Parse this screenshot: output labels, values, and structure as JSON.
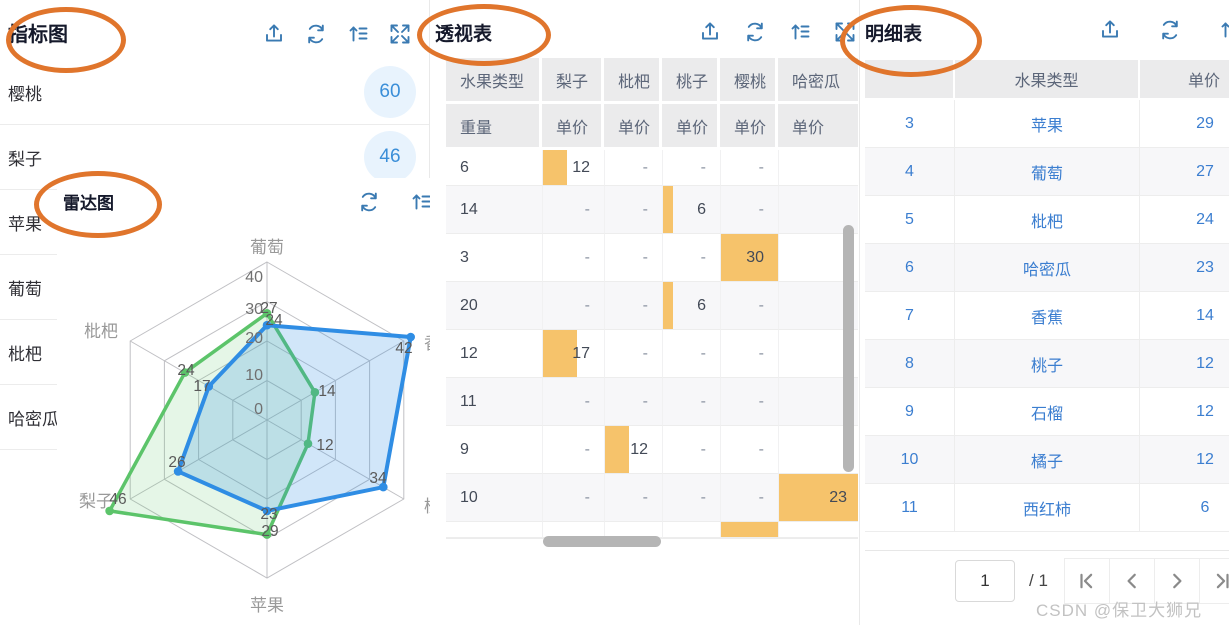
{
  "colors": {
    "annotation": "#e0752c",
    "toolbar_icon": "#3a7ab2",
    "orange_bar": "#f6c36b",
    "series_blue": "#2f8de4",
    "series_green": "#5cc46a",
    "badge_bg": "#e8f3fd",
    "badge_text": "#3a8ed8"
  },
  "indicator": {
    "title": "指标图",
    "toolbar": [
      "upload",
      "refresh",
      "sort",
      "expand"
    ],
    "items": [
      {
        "label": "樱桃",
        "value": "60"
      },
      {
        "label": "梨子",
        "value": "46"
      },
      {
        "label": "苹果",
        "value": ""
      },
      {
        "label": "葡萄",
        "value": ""
      },
      {
        "label": "枇杷",
        "value": ""
      },
      {
        "label": "哈密瓜",
        "value": ""
      }
    ]
  },
  "radar": {
    "title": "雷达图",
    "toolbar": [
      "refresh",
      "sort"
    ]
  },
  "pivot": {
    "title": "透视表",
    "toolbar": [
      "upload",
      "refresh",
      "sort",
      "expand"
    ],
    "columns": [
      "水果类型",
      "梨子",
      "枇杷",
      "桃子",
      "樱桃",
      "哈密瓜"
    ],
    "measures": [
      "重量",
      "单价",
      "单价",
      "单价",
      "单价",
      "单价"
    ],
    "rows": [
      {
        "weight": "6",
        "cells": [
          {
            "v": "12",
            "bar": 40
          },
          {
            "v": "-",
            "bar": 0
          },
          {
            "v": "-",
            "bar": 0
          },
          {
            "v": "-",
            "bar": 0
          },
          {
            "v": "",
            "bar": 0
          }
        ]
      },
      {
        "weight": "14",
        "cells": [
          {
            "v": "-",
            "bar": 0
          },
          {
            "v": "-",
            "bar": 0
          },
          {
            "v": "6",
            "bar": 18
          },
          {
            "v": "-",
            "bar": 0
          },
          {
            "v": "",
            "bar": 0
          }
        ]
      },
      {
        "weight": "3",
        "cells": [
          {
            "v": "-",
            "bar": 0
          },
          {
            "v": "-",
            "bar": 0
          },
          {
            "v": "-",
            "bar": 0
          },
          {
            "v": "30",
            "bar": 100
          },
          {
            "v": "",
            "bar": 0
          }
        ]
      },
      {
        "weight": "20",
        "cells": [
          {
            "v": "-",
            "bar": 0
          },
          {
            "v": "-",
            "bar": 0
          },
          {
            "v": "6",
            "bar": 18
          },
          {
            "v": "-",
            "bar": 0
          },
          {
            "v": "",
            "bar": 0
          }
        ]
      },
      {
        "weight": "12",
        "cells": [
          {
            "v": "17",
            "bar": 55
          },
          {
            "v": "-",
            "bar": 0
          },
          {
            "v": "-",
            "bar": 0
          },
          {
            "v": "-",
            "bar": 0
          },
          {
            "v": "",
            "bar": 0
          }
        ]
      },
      {
        "weight": "11",
        "cells": [
          {
            "v": "-",
            "bar": 0
          },
          {
            "v": "-",
            "bar": 0
          },
          {
            "v": "-",
            "bar": 0
          },
          {
            "v": "-",
            "bar": 0
          },
          {
            "v": "",
            "bar": 0
          }
        ]
      },
      {
        "weight": "9",
        "cells": [
          {
            "v": "-",
            "bar": 0
          },
          {
            "v": "12",
            "bar": 42
          },
          {
            "v": "-",
            "bar": 0
          },
          {
            "v": "-",
            "bar": 0
          },
          {
            "v": "",
            "bar": 0
          }
        ]
      },
      {
        "weight": "10",
        "cells": [
          {
            "v": "-",
            "bar": 0
          },
          {
            "v": "-",
            "bar": 0
          },
          {
            "v": "-",
            "bar": 0
          },
          {
            "v": "-",
            "bar": 0
          },
          {
            "v": "23",
            "bar": 100
          }
        ]
      },
      {
        "weight": "",
        "cells": [
          {
            "v": "",
            "bar": 0
          },
          {
            "v": "",
            "bar": 0
          },
          {
            "v": "",
            "bar": 0
          },
          {
            "v": "",
            "bar": 100
          },
          {
            "v": "",
            "bar": 0
          }
        ]
      }
    ]
  },
  "detail": {
    "title": "明细表",
    "toolbar": [
      "upload",
      "refresh",
      "sort"
    ],
    "columns": [
      "",
      "水果类型",
      "单价"
    ],
    "rows": [
      [
        "3",
        "苹果",
        "29"
      ],
      [
        "4",
        "葡萄",
        "27"
      ],
      [
        "5",
        "枇杷",
        "24"
      ],
      [
        "6",
        "哈密瓜",
        "23"
      ],
      [
        "7",
        "香蕉",
        "14"
      ],
      [
        "8",
        "桃子",
        "12"
      ],
      [
        "9",
        "石榴",
        "12"
      ],
      [
        "10",
        "橘子",
        "12"
      ],
      [
        "11",
        "西红柿",
        "6"
      ]
    ],
    "pagination": {
      "page": "1",
      "of": "/ 1",
      "buttons": [
        "first",
        "prev",
        "next",
        "last"
      ]
    }
  },
  "watermark": "CSDN @保卫大狮兄",
  "chart_data": {
    "type": "radar",
    "title": "雷达图",
    "categories": [
      "葡萄",
      "香蕉",
      "桃子",
      "苹果",
      "梨子",
      "枇杷"
    ],
    "max": 40,
    "ticks": [
      0,
      10,
      20,
      30,
      40
    ],
    "series": [
      {
        "name": "weight-series",
        "color": "#2f8de4",
        "values": [
          24,
          42,
          34,
          23,
          26,
          17
        ]
      },
      {
        "name": "price-series",
        "color": "#5cc46a",
        "values": [
          27,
          14,
          12,
          29,
          46,
          24
        ]
      }
    ]
  }
}
